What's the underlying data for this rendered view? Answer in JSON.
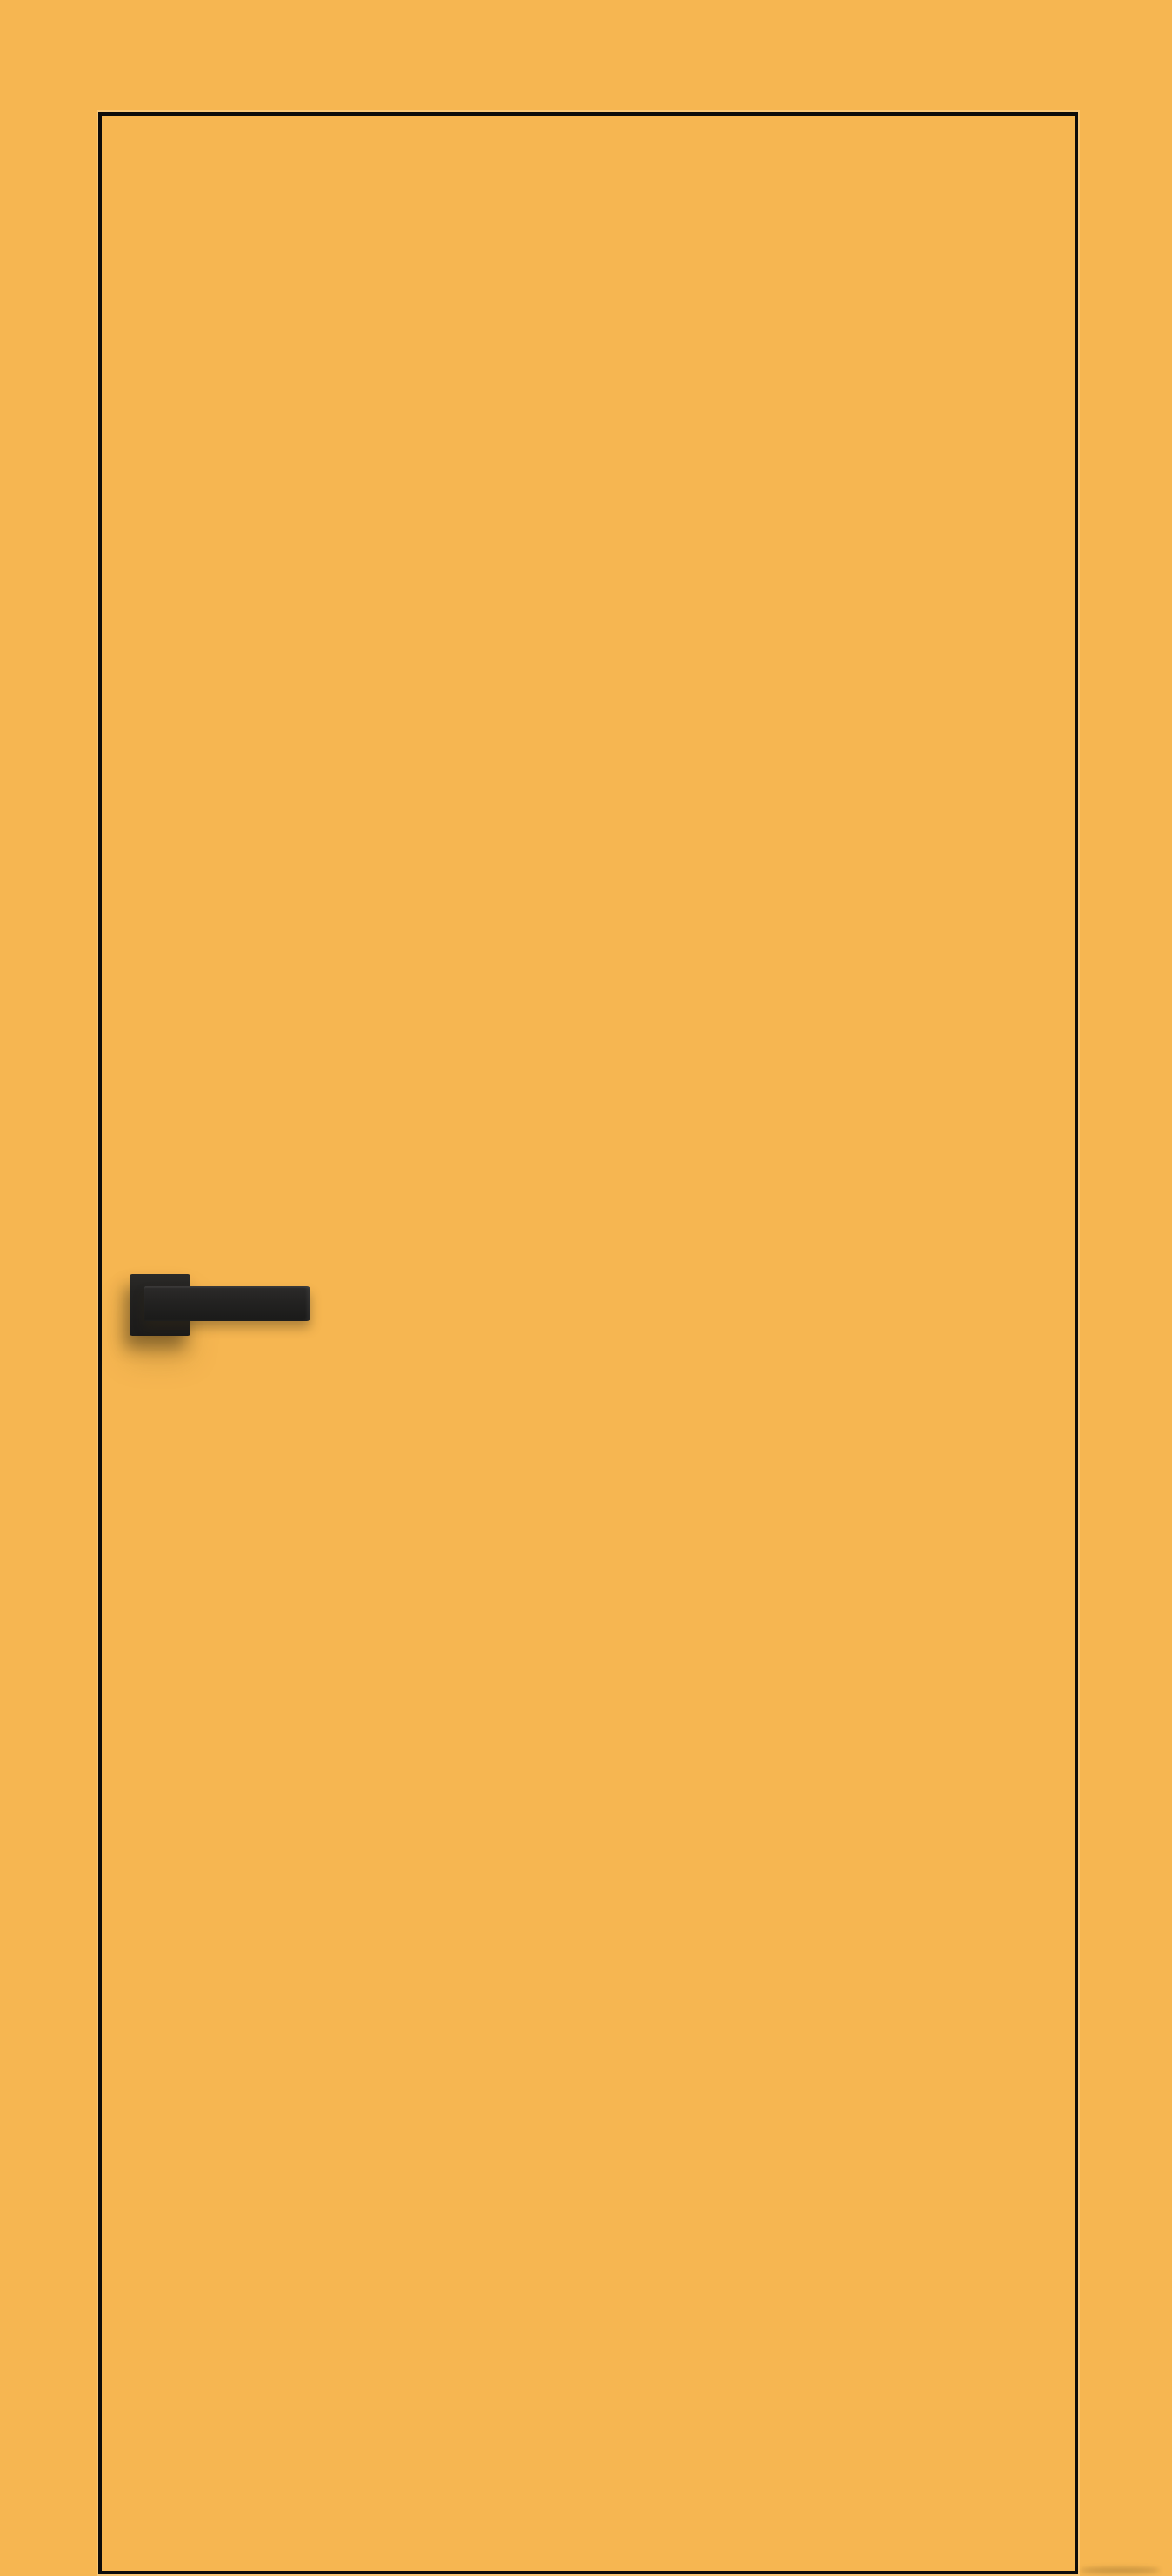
{
  "scene": {
    "description": "Front view of a plain orange interior door leaf with a thin black edge outline and a black square-rosette lever handle on the left side",
    "door": {
      "handle_side": "left",
      "glazing": "none",
      "panel_style": "flush"
    },
    "colors": {
      "background": "#F6B651",
      "door_face": "#F6B651",
      "outline": "#0D0C0A",
      "handle_dark": "#1E1D1B",
      "handle_mid": "#262524",
      "edge_highlight": "rgba(255, 238, 205, 0.30)"
    }
  }
}
